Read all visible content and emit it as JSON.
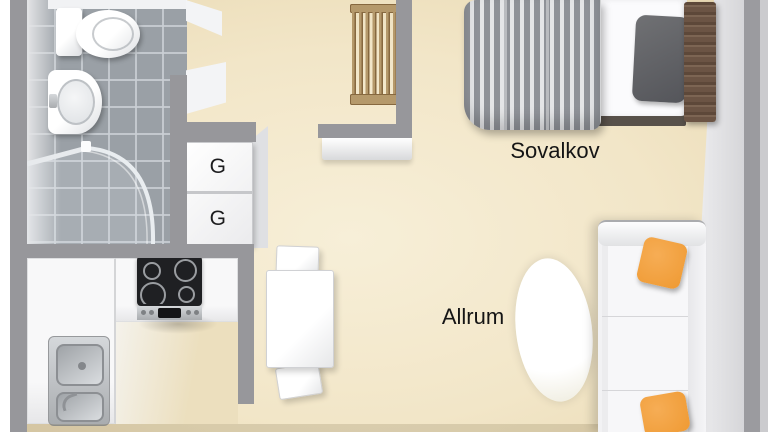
{
  "view": "3d-floorplan-top-view",
  "labels": {
    "sleeping_alcove": "Sovalkov",
    "living_room": "Allrum",
    "wardrobe_upper": "G",
    "wardrobe_lower": "G"
  },
  "rooms": [
    {
      "name": "bathroom",
      "furniture": [
        "toilet",
        "washbasin",
        "corner-shower"
      ]
    },
    {
      "name": "kitchen",
      "furniture": [
        "cooktop",
        "double-sink",
        "l-shaped-counter"
      ]
    },
    {
      "name": "hall",
      "furniture": [
        "wardrobe-g",
        "wardrobe-g",
        "wooden-slat-rack",
        "wall-shelf"
      ]
    },
    {
      "name": "sleeping-alcove",
      "furniture": [
        "single-bed",
        "striped-duvet",
        "pillow",
        "headboard"
      ]
    },
    {
      "name": "living-room",
      "furniture": [
        "sofa",
        "orange-cushion",
        "orange-cushion",
        "oval-rug",
        "dining-table",
        "chair",
        "chair"
      ]
    }
  ],
  "colors": {
    "floor": "#f2e6c8",
    "wall": "#97979b",
    "tile": "#9aa0a6",
    "orange": "#ef9a33",
    "wood": "#b5996b",
    "wood_dark": "#86683f",
    "duvet": "#8f9298",
    "duvet_light": "#e4e5e7",
    "headboard": "#6b5444",
    "bedbase": "#58514a"
  }
}
